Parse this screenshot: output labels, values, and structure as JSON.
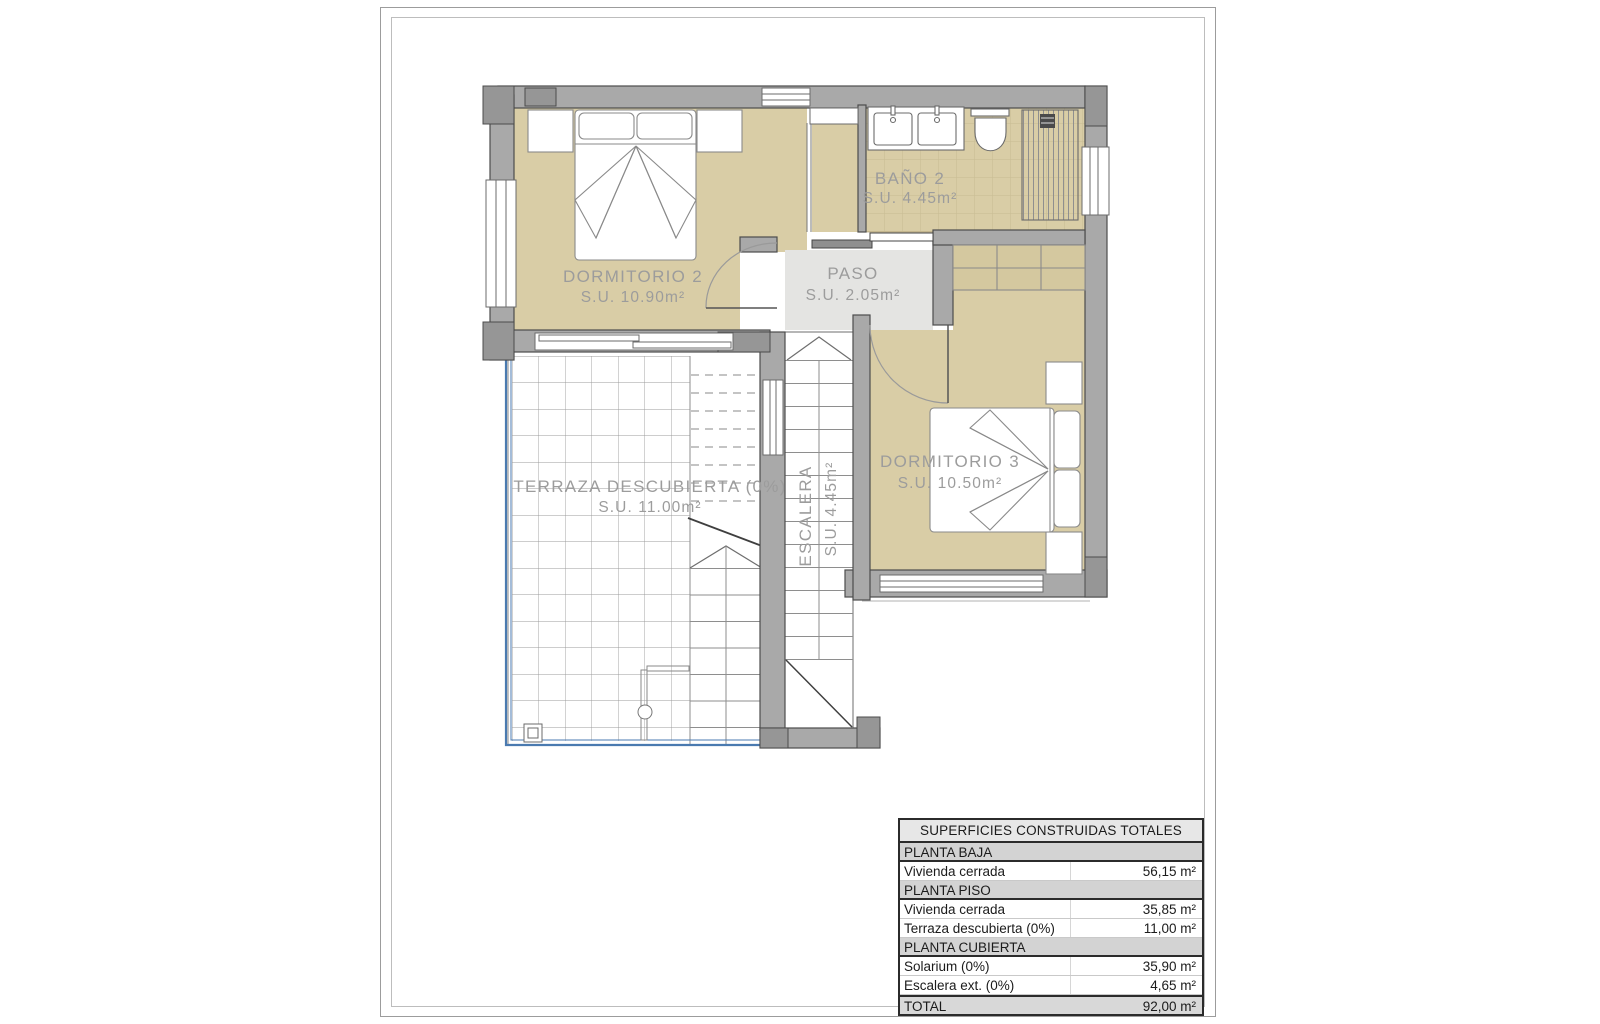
{
  "document": {
    "kind": "floor-plan"
  },
  "rooms": [
    {
      "id": "dormitorio2",
      "name": "DORMITORIO 2",
      "area": "S.U. 10.90m²"
    },
    {
      "id": "bano2",
      "name": "BAÑO 2",
      "area": "S.U. 4.45m²"
    },
    {
      "id": "paso",
      "name": "PASO",
      "area": "S.U. 2.05m²"
    },
    {
      "id": "dormitorio3",
      "name": "DORMITORIO 3",
      "area": "S.U. 10.50m²"
    },
    {
      "id": "terraza",
      "name": "TERRAZA DESCUBIERTA (0%)",
      "area": "S.U. 11.00m²"
    },
    {
      "id": "escalera",
      "name": "ESCALERA",
      "area": "S.U. 4.45m²"
    }
  ],
  "table": {
    "title": "SUPERFICIES CONSTRUIDAS TOTALES",
    "rows": [
      {
        "type": "section",
        "label": "PLANTA BAJA",
        "value": ""
      },
      {
        "type": "data",
        "label": "Vivienda cerrada",
        "value": "56,15 m²"
      },
      {
        "type": "section",
        "label": "PLANTA PISO",
        "value": ""
      },
      {
        "type": "data",
        "label": "Vivienda cerrada",
        "value": "35,85 m²"
      },
      {
        "type": "data",
        "label": "Terraza descubierta (0%)",
        "value": "11,00 m²"
      },
      {
        "type": "section",
        "label": "PLANTA CUBIERTA",
        "value": ""
      },
      {
        "type": "data",
        "label": "Solarium (0%)",
        "value": "35,90 m²"
      },
      {
        "type": "data",
        "label": "Escalera ext. (0%)",
        "value": "4,65 m²"
      },
      {
        "type": "total",
        "label": "TOTAL",
        "value": "92,00 m²"
      }
    ]
  },
  "colors": {
    "wall": "#a9a9a9",
    "wall_dark": "#969696",
    "floor_beige": "#d9cda6",
    "paso_gray": "#e4e4e2",
    "tile_line": "#c8bb93",
    "railing_blue": "#4a7ab0",
    "label_gray": "#9c9c9c",
    "table_section_bg": "#d3d3d3"
  }
}
